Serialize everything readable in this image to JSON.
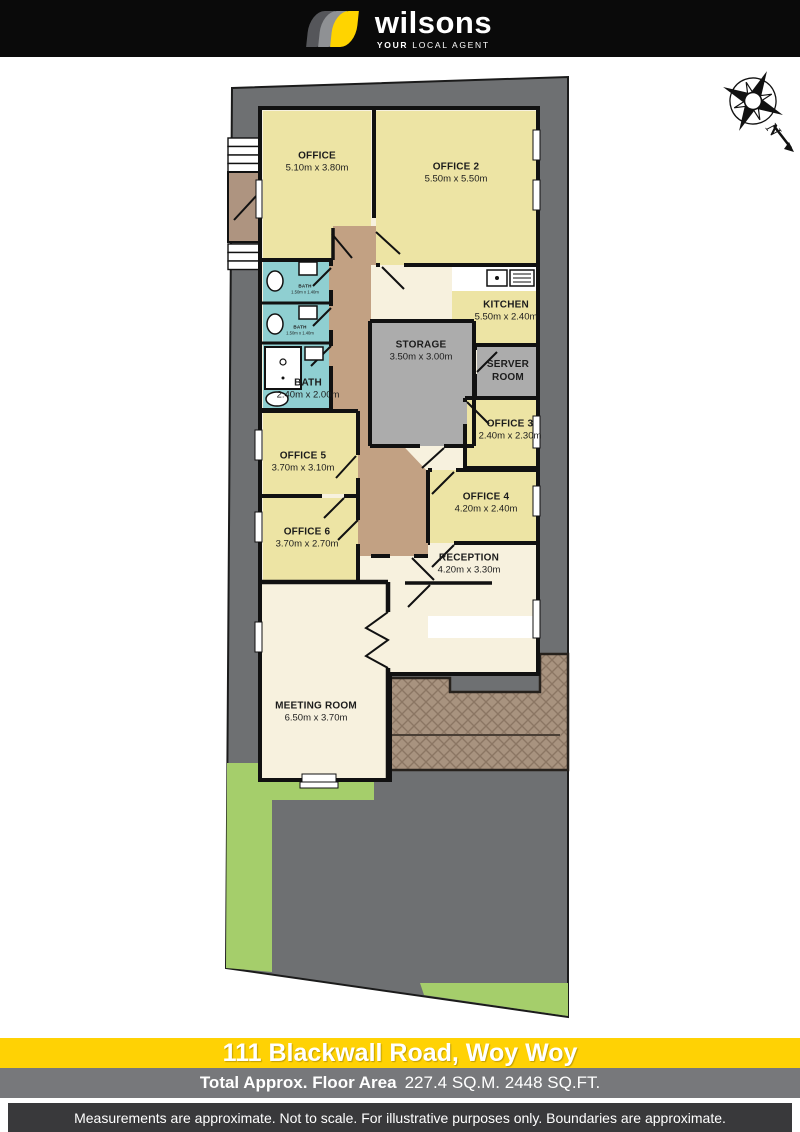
{
  "header": {
    "brand": "wilsons",
    "tagline_bold": "YOUR",
    "tagline_rest": " LOCAL AGENT"
  },
  "compass": {
    "label": "N"
  },
  "rooms": [
    {
      "name": "OFFICE",
      "dims": "5.10m x 3.80m"
    },
    {
      "name": "OFFICE 2",
      "dims": "5.50m x 5.50m"
    },
    {
      "name": "BATH",
      "dims": "1.50m x 1.40m"
    },
    {
      "name": "BATH",
      "dims": "1.50m x 1.40m"
    },
    {
      "name": "BATH",
      "dims": "2.40m x 2.00m"
    },
    {
      "name": "KITCHEN",
      "dims": "5.50m x 2.40m"
    },
    {
      "name": "STORAGE",
      "dims": "3.50m x 3.00m"
    },
    {
      "name": "SERVER ROOM",
      "dims": ""
    },
    {
      "name": "OFFICE 3",
      "dims": "2.40m x 2.30m"
    },
    {
      "name": "OFFICE 5",
      "dims": "3.70m x 3.10m"
    },
    {
      "name": "OFFICE 4",
      "dims": "4.20m x 2.40m"
    },
    {
      "name": "OFFICE 6",
      "dims": "3.70m x 2.70m"
    },
    {
      "name": "RECEPTION",
      "dims": "4.20m x 3.30m"
    },
    {
      "name": "MEETING ROOM",
      "dims": "6.50m x 3.70m"
    }
  ],
  "footer": {
    "address": "111 Blackwall Road, Woy Woy",
    "area_label": "Total Approx. Floor Area",
    "area_value": "227.4 SQ.M. 2448 SQ.FT.",
    "disclaimer": "Measurements are approximate. Not to scale. For illustrative purposes only. Boundaries are approximate."
  },
  "colors": {
    "brand_yellow": "#FFD400",
    "footer_yellow": "#FFD204",
    "footer_gray": "#77787B",
    "footer_dark": "#39393B",
    "lot": "#6E7072",
    "grass": "#A5CE6B",
    "room_yellow": "#EDE4A4",
    "room_cream": "#F7F1DE",
    "bath_teal": "#8FCFD1",
    "corridor_tan": "#C2A183",
    "storage_gray": "#ACACAC",
    "deck_brown": "#A8937F",
    "wall": "#111111"
  }
}
